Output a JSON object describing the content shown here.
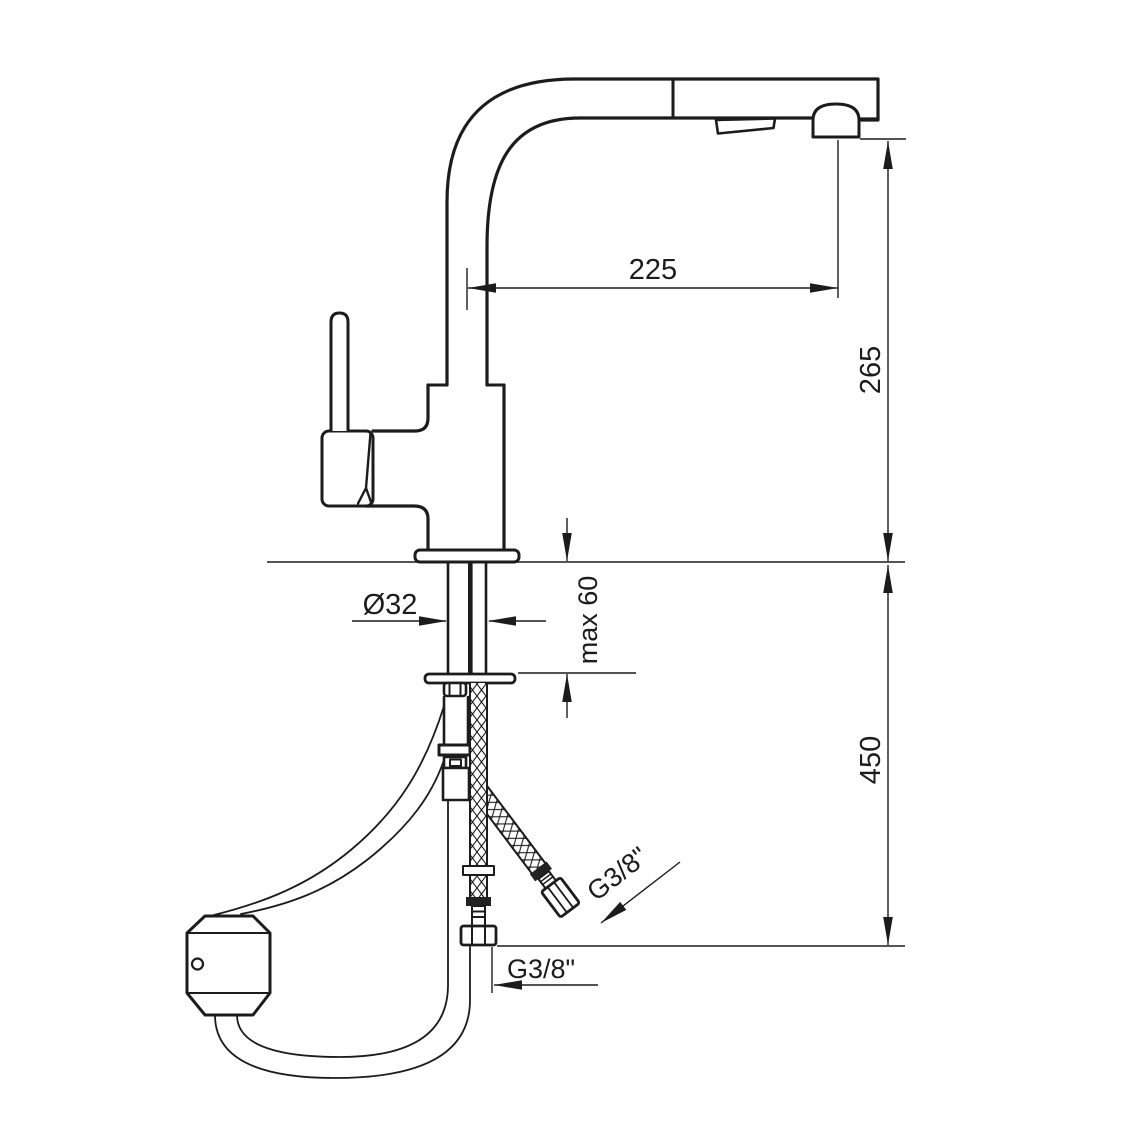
{
  "background": "#ffffff",
  "ink": "#1c1c1c",
  "drawing_type": "installation dimension drawing",
  "dimensions": {
    "spout_reach": "225",
    "outlet_height": "265",
    "below_counter_depth": "450",
    "hole_diameter": "Ø32",
    "max_counter_thickness": "max 60",
    "hose_thread_side": "G3/8\"",
    "hose_thread_bottom": "G3/8\""
  }
}
